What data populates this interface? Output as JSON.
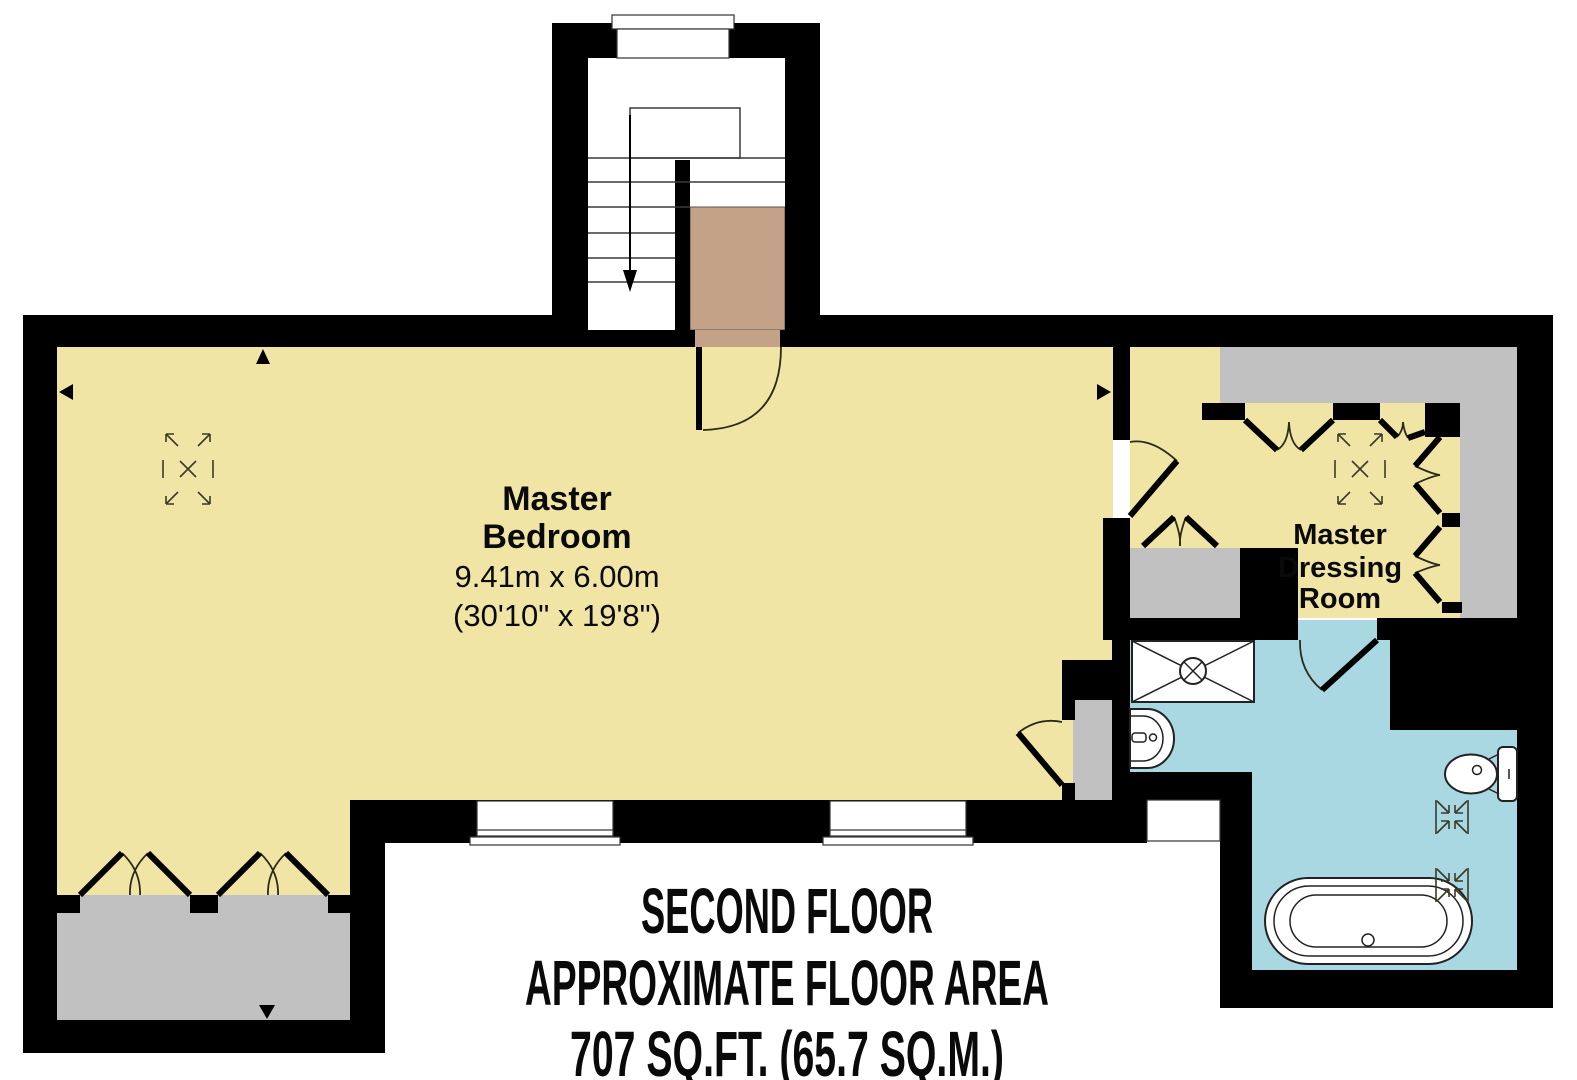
{
  "floor_plan": {
    "floor_name": "SECOND FLOOR",
    "area_label": "APPROXIMATE FLOOR AREA",
    "area_value": "707 SQ.FT. (65.7 SQ.M.)"
  },
  "rooms": {
    "master_bedroom": {
      "name_line1": "Master",
      "name_line2": "Bedroom",
      "dim_metric": "9.41m x 6.00m",
      "dim_imperial": "(30'10\" x 19'8\")"
    },
    "master_dressing_room": {
      "name_line1": "Master",
      "name_line2": "Dressing",
      "name_line3": "Room"
    }
  },
  "colors": {
    "wall": "#000000",
    "room_floor": "#F1E5A6",
    "storage_floor": "#C1C1C1",
    "bathroom_floor": "#A9D8E2",
    "stair_landing": "#C3A287"
  }
}
